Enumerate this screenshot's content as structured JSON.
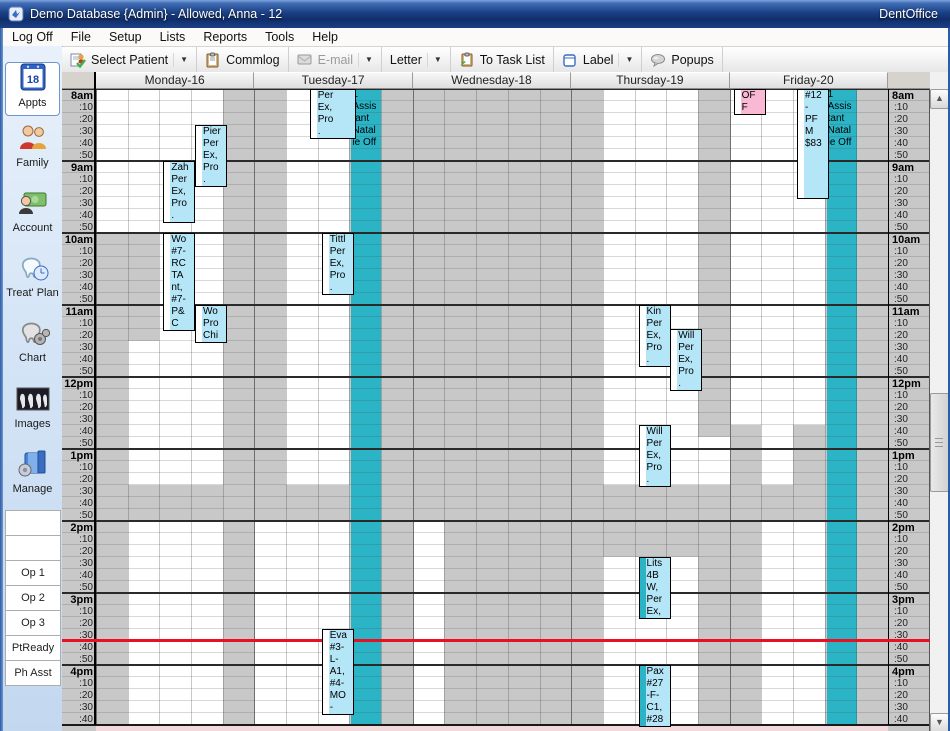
{
  "window": {
    "title": "Demo Database {Admin} - Allowed, Anna - 12",
    "brand": "DentOffice"
  },
  "menu": {
    "items": [
      "Log Off",
      "File",
      "Setup",
      "Lists",
      "Reports",
      "Tools",
      "Help"
    ]
  },
  "toolbar": {
    "buttons": [
      {
        "label": "Select Patient",
        "icon": "select-patient-icon",
        "dropdown": true,
        "disabled": false
      },
      {
        "label": "Commlog",
        "icon": "commlog-icon",
        "dropdown": false,
        "disabled": false
      },
      {
        "label": "E-mail",
        "icon": "email-icon",
        "dropdown": true,
        "disabled": true
      },
      {
        "label": "Letter",
        "icon": "",
        "dropdown": true,
        "disabled": false
      },
      {
        "label": "To Task List",
        "icon": "tasklist-icon",
        "dropdown": false,
        "disabled": false
      },
      {
        "label": "Label",
        "icon": "label-icon",
        "dropdown": true,
        "disabled": false
      },
      {
        "label": "Popups",
        "icon": "popups-icon",
        "dropdown": false,
        "disabled": false
      }
    ]
  },
  "sidebar": {
    "modules": [
      {
        "label": "Appts",
        "icon": "appts-icon",
        "selected": true
      },
      {
        "label": "Family",
        "icon": "family-icon",
        "selected": false
      },
      {
        "label": "Account",
        "icon": "account-icon",
        "selected": false
      },
      {
        "label": "Treat' Plan",
        "icon": "treatplan-icon",
        "selected": false
      },
      {
        "label": "Chart",
        "icon": "chart-icon",
        "selected": false
      },
      {
        "label": "Images",
        "icon": "images-icon",
        "selected": false
      },
      {
        "label": "Manage",
        "icon": "manage-icon",
        "selected": false
      }
    ],
    "op_rows": [
      "",
      "",
      "Op 1",
      "Op 2",
      "Op 3",
      "PtReady",
      "Ph Asst"
    ]
  },
  "icons": {
    "scroll-up": "▲",
    "scroll-down": "▼",
    "dropdown": "▼"
  },
  "schedule": {
    "days": [
      "Monday-16",
      "Tuesday-17",
      "Wednesday-18",
      "Thursday-19",
      "Friday-20"
    ],
    "hours": [
      "8am",
      "9am",
      "10am",
      "11am",
      "12pm",
      "1pm",
      "2pm",
      "3pm",
      "4pm"
    ],
    "minute_labels": [
      ":10",
      ":20",
      ":30",
      ":40",
      ":50"
    ],
    "time_indicator": "15:39",
    "open_blocks": [
      {
        "day": 0,
        "cols": [
          0,
          0
        ],
        "from": "8:00",
        "to": "10:00"
      },
      {
        "day": 0,
        "cols": [
          1,
          3
        ],
        "from": "8:00",
        "to": "10:00"
      },
      {
        "day": 0,
        "cols": [
          2,
          3
        ],
        "from": "10:00",
        "to": "11:30"
      },
      {
        "day": 0,
        "cols": [
          1,
          3
        ],
        "from": "11:30",
        "to": "13:30"
      },
      {
        "day": 0,
        "cols": [
          1,
          3
        ],
        "from": "14:00",
        "to": "17:00"
      },
      {
        "day": 1,
        "cols": [
          1,
          2
        ],
        "from": "8:00",
        "to": "13:30"
      },
      {
        "day": 1,
        "cols": [
          0,
          2
        ],
        "from": "14:00",
        "to": "17:00"
      },
      {
        "day": 2,
        "cols": [
          0,
          0
        ],
        "from": "14:00",
        "to": "17:00"
      },
      {
        "day": 3,
        "cols": [
          1,
          3
        ],
        "from": "8:00",
        "to": "13:30"
      },
      {
        "day": 3,
        "cols": [
          4,
          4
        ],
        "from": "12:50",
        "to": "13:30"
      },
      {
        "day": 3,
        "cols": [
          1,
          3
        ],
        "from": "14:30",
        "to": "17:00"
      },
      {
        "day": 4,
        "cols": [
          0,
          2
        ],
        "from": "8:00",
        "to": "12:40"
      },
      {
        "day": 4,
        "cols": [
          1,
          1
        ],
        "from": "12:40",
        "to": "13:30"
      },
      {
        "day": 4,
        "cols": [
          1,
          2
        ],
        "from": "14:00",
        "to": "17:00"
      }
    ],
    "blockouts": [
      {
        "day": 1,
        "col": 3,
        "lines": [
          "1",
          "Assis",
          "tant",
          "Natal",
          "ie Off"
        ]
      },
      {
        "day": 4,
        "col": 3,
        "lines": [
          "1",
          "Assis",
          "tant",
          "Natal",
          "ie Off"
        ]
      }
    ],
    "appointments": [
      {
        "day": 0,
        "col": 3,
        "from": "8:30",
        "to": "9:20",
        "lines": [
          "Pier",
          "Per",
          "Ex,",
          "Pro",
          "."
        ],
        "style": "default",
        "bar": "white"
      },
      {
        "day": 0,
        "col": 2,
        "from": "9:00",
        "to": "9:50",
        "lines": [
          "Zah",
          "Per",
          "Ex,",
          "Pro",
          "."
        ],
        "style": "default",
        "bar": "white"
      },
      {
        "day": 0,
        "col": 2,
        "from": "10:00",
        "to": "11:20",
        "lines": [
          "Wo",
          "#7-",
          "RC",
          "TA",
          "nt,",
          "#7-",
          "P&",
          "C"
        ],
        "style": "default",
        "bar": "white"
      },
      {
        "day": 0,
        "col": 3,
        "from": "11:00",
        "to": "11:30",
        "lines": [
          "Wo",
          "Pro",
          "Chi"
        ],
        "style": "default",
        "bar": "white"
      },
      {
        "day": 1,
        "col": 2,
        "from": "8:00",
        "to": "8:40",
        "lines": [
          "Per",
          "Ex,",
          "Pro",
          "."
        ],
        "style": "default",
        "bar": "white",
        "wide": true
      },
      {
        "day": 1,
        "col": 2,
        "from": "10:00",
        "to": "10:50",
        "lines": [
          "Tittl",
          "Per",
          "Ex,",
          "Pro",
          "."
        ],
        "style": "default",
        "bar": "white"
      },
      {
        "day": 1,
        "col": 2,
        "from": "15:30",
        "to": "16:40",
        "lines": [
          "Eva",
          "#3-",
          "L-",
          "A1,",
          "#4-",
          "MO",
          "-"
        ],
        "style": "default",
        "bar": "white"
      },
      {
        "day": 3,
        "col": 2,
        "from": "11:00",
        "to": "11:50",
        "lines": [
          "Kin",
          "Per",
          "Ex,",
          "Pro",
          "."
        ],
        "style": "default",
        "bar": "white"
      },
      {
        "day": 3,
        "col": 3,
        "from": "11:20",
        "to": "12:10",
        "lines": [
          "Will",
          "Per",
          "Ex,",
          "Pro",
          "."
        ],
        "style": "default",
        "bar": "white"
      },
      {
        "day": 3,
        "col": 2,
        "from": "12:40",
        "to": "13:30",
        "lines": [
          "Will",
          "Per",
          "Ex,",
          "Pro",
          "."
        ],
        "style": "default",
        "bar": "white"
      },
      {
        "day": 3,
        "col": 2,
        "from": "14:30",
        "to": "15:20",
        "lines": [
          "Lits",
          "4B",
          "W,",
          "Per",
          "Ex,"
        ],
        "style": "default",
        "bar": "teal"
      },
      {
        "day": 3,
        "col": 2,
        "from": "16:00",
        "to": "16:50",
        "lines": [
          "Pax",
          "#27",
          "-F-",
          "C1,",
          "#28"
        ],
        "style": "default",
        "bar": "teal"
      },
      {
        "day": 4,
        "col": 0,
        "from": "8:00",
        "to": "8:20",
        "lines": [
          "OF",
          "F"
        ],
        "style": "pink",
        "bar": "white"
      },
      {
        "day": 4,
        "col": 2,
        "from": "8:00",
        "to": "9:30",
        "lines": [
          "#12",
          "-",
          "PF",
          "M",
          "$83"
        ],
        "style": "default",
        "bar": "white"
      }
    ],
    "colors": {
      "closed": "#c8c8c8",
      "open": "#ffffff",
      "blockout": "#2ab4c6",
      "appointment": "#b5e6f7",
      "appointment_off": "#f9b8d4",
      "bar_white": "#ffffff",
      "time_line": "#e81123",
      "bottom_strip": "#f2dadc"
    }
  }
}
